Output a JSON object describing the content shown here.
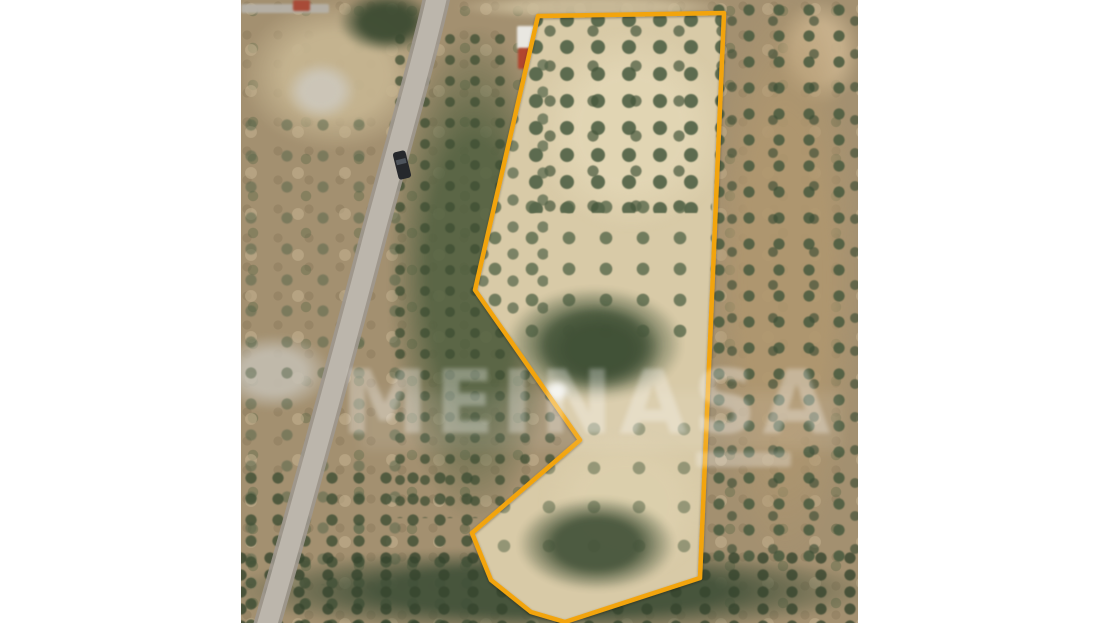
{
  "scene": {
    "description": "Aerial satellite photograph of a rural land plot with olive trees, outlined with an orange property boundary, flanked by white margins",
    "margin_color": "#ffffff"
  },
  "watermark": {
    "text": "MEINASA",
    "color": "rgba(255,255,255,0.30)"
  },
  "boundary": {
    "color": "#F2A40D",
    "stroke_width": 4.5,
    "points": [
      [
        297,
        16
      ],
      [
        483,
        13
      ],
      [
        459,
        578
      ],
      [
        324,
        622
      ],
      [
        290,
        612
      ],
      [
        250,
        580
      ],
      [
        231,
        533
      ],
      [
        339,
        440
      ],
      [
        234,
        290
      ]
    ]
  },
  "road": {
    "path": "M 197,-8 C 182,60 150,170 131,242 C 112,315 65,490 24,632",
    "casing_color": "#9e988f",
    "surface_color": "#bcb6ac"
  },
  "car": {
    "transform": "translate(161,165) rotate(-14)",
    "body_color": "#26282c",
    "glass_color": "#4e545c"
  },
  "terrain_zones": [
    {
      "layer": "photo",
      "name": "bare-ground-top-left",
      "type": "blob",
      "x": 0,
      "y": 0,
      "w": 190,
      "h": 150,
      "color": "#c6b591",
      "opacity": 0.95
    },
    {
      "layer": "photo",
      "name": "dirt-path-top",
      "type": "blob",
      "x": 215,
      "y": -6,
      "w": 275,
      "h": 26,
      "color": "#ccbd9b",
      "opacity": 0.9
    },
    {
      "layer": "photo",
      "name": "bare-ground-top-right",
      "type": "blob",
      "x": 535,
      "y": 0,
      "w": 85,
      "h": 105,
      "color": "#c9b28d",
      "opacity": 0.95
    },
    {
      "layer": "photo",
      "name": "rock-outcrop-upper",
      "type": "blob",
      "x": 45,
      "y": 62,
      "w": 70,
      "h": 58,
      "color": "#cdc8bc",
      "opacity": 0.9
    },
    {
      "layer": "photo",
      "name": "rock-outcrop-mid",
      "type": "blob",
      "x": -25,
      "y": 335,
      "w": 115,
      "h": 75,
      "color": "#c6c1b5",
      "opacity": 0.85
    },
    {
      "layer": "photo",
      "name": "scrub-left-field",
      "type": "dots",
      "x": 0,
      "y": 115,
      "w": 165,
      "h": 470,
      "color": "#55654a",
      "opacity": 0.5,
      "grid": [
        36,
        31
      ],
      "r": 8
    },
    {
      "layer": "photo",
      "name": "green-strip-base",
      "type": "blob",
      "x": 148,
      "y": 28,
      "w": 170,
      "h": 490,
      "color": "#4f5f3f",
      "opacity": 0.85
    },
    {
      "layer": "photo",
      "name": "green-strip-trees",
      "type": "dots",
      "x": 150,
      "y": 30,
      "w": 168,
      "h": 488,
      "color": "#3e4e33",
      "opacity": 0.75,
      "grid": [
        25,
        21
      ],
      "r": 7
    },
    {
      "layer": "photo",
      "name": "olive-grove-right-soil",
      "type": "blob",
      "x": 468,
      "y": -10,
      "w": 152,
      "h": 575,
      "color": "#b0976f",
      "opacity": 0.9
    },
    {
      "layer": "photo",
      "name": "olive-grove-right-trees",
      "type": "dots",
      "x": 468,
      "y": 0,
      "w": 150,
      "h": 562,
      "color": "#4d5d41",
      "opacity": 0.9,
      "grid": [
        30,
        26
      ],
      "r": 8
    },
    {
      "layer": "photo",
      "name": "olive-grove-right-trees-b",
      "type": "dots",
      "x": 468,
      "y": 0,
      "w": 150,
      "h": 562,
      "color": "#3f4f37",
      "opacity": 0.65,
      "grid": [
        41,
        33
      ],
      "r": 7,
      "offset": [
        14,
        12
      ]
    },
    {
      "layer": "photo",
      "name": "hedge-top",
      "type": "blob",
      "x": 98,
      "y": -8,
      "w": 95,
      "h": 60,
      "color": "#3c4b32",
      "opacity": 0.95
    },
    {
      "layer": "photo",
      "name": "wall-top",
      "type": "solid",
      "x": 0,
      "y": 4,
      "w": 88,
      "h": 9,
      "color": "#b6b1a7",
      "opacity": 0.95
    },
    {
      "layer": "photo",
      "name": "red-roof-hut",
      "type": "solid",
      "x": 52,
      "y": 0,
      "w": 17,
      "h": 11,
      "color": "#a84b38",
      "opacity": 1
    },
    {
      "layer": "photo",
      "name": "trees-bottom-left",
      "type": "dots",
      "x": 0,
      "y": 468,
      "w": 245,
      "h": 158,
      "color": "#3e4e34",
      "opacity": 0.8,
      "grid": [
        27,
        21
      ],
      "r": 8
    },
    {
      "layer": "photo",
      "name": "tree-band-bottom",
      "type": "blob",
      "x": -10,
      "y": 548,
      "w": 640,
      "h": 85,
      "color": "#43523a",
      "opacity": 0.95
    },
    {
      "layer": "photo",
      "name": "tree-band-bottom-texture",
      "type": "dots",
      "x": -10,
      "y": 548,
      "w": 640,
      "h": 80,
      "color": "#36452e",
      "opacity": 0.8,
      "grid": [
        29,
        17
      ],
      "r": 8
    },
    {
      "layer": "photo",
      "name": "building-white-roof",
      "type": "solid",
      "x": 276,
      "y": 26,
      "w": 21,
      "h": 23,
      "color": "#e9e7e1",
      "opacity": 1
    },
    {
      "layer": "photo",
      "name": "building-red-roof",
      "type": "solid",
      "x": 277,
      "y": 48,
      "w": 19,
      "h": 21,
      "color": "#b1452f",
      "opacity": 1
    },
    {
      "layer": "plot",
      "name": "plot-bare-soil",
      "type": "solid",
      "x": 0,
      "y": 0,
      "w": 617,
      "h": 623,
      "color": "#d8caa7",
      "opacity": 1
    },
    {
      "layer": "plot",
      "name": "plot-bright-soil-upper",
      "type": "blob",
      "x": 290,
      "y": 30,
      "w": 200,
      "h": 200,
      "color": "#e3d7b6",
      "opacity": 0.85
    },
    {
      "layer": "plot",
      "name": "plot-bright-soil-lower",
      "type": "blob",
      "x": 300,
      "y": 430,
      "w": 170,
      "h": 150,
      "color": "#ddd0ae",
      "opacity": 0.8
    },
    {
      "layer": "plot",
      "name": "plot-olive-rows-upper",
      "type": "dots",
      "x": 283,
      "y": 8,
      "w": 205,
      "h": 205,
      "color": "#56664a",
      "opacity": 0.95,
      "grid": [
        31,
        27
      ],
      "r": 10
    },
    {
      "layer": "plot",
      "name": "plot-olive-rows-upper-b",
      "type": "dots",
      "x": 283,
      "y": 8,
      "w": 205,
      "h": 205,
      "color": "#47573d",
      "opacity": 0.7,
      "grid": [
        43,
        35
      ],
      "r": 8,
      "offset": [
        16,
        13
      ]
    },
    {
      "layer": "plot",
      "name": "plot-trees-west-edge",
      "type": "dots",
      "x": 232,
      "y": 55,
      "w": 75,
      "h": 260,
      "color": "#55654a",
      "opacity": 0.7,
      "grid": [
        30,
        27
      ],
      "r": 8
    },
    {
      "layer": "plot",
      "name": "plot-olive-rows-mid",
      "type": "dots",
      "x": 243,
      "y": 196,
      "w": 228,
      "h": 150,
      "color": "#58684b",
      "opacity": 0.8,
      "grid": [
        37,
        31
      ],
      "r": 9
    },
    {
      "layer": "plot",
      "name": "plot-tree-mass-mid",
      "type": "blob",
      "x": 266,
      "y": 288,
      "w": 175,
      "h": 112,
      "color": "#4d5d41",
      "opacity": 0.95
    },
    {
      "layer": "plot",
      "name": "plot-tree-mass-mid-core",
      "type": "blob",
      "x": 298,
      "y": 308,
      "w": 120,
      "h": 82,
      "color": "#405036",
      "opacity": 0.9
    },
    {
      "layer": "plot",
      "name": "plot-trees-lower-sparse",
      "type": "dots",
      "x": 252,
      "y": 418,
      "w": 205,
      "h": 145,
      "color": "#5c6b4e",
      "opacity": 0.55,
      "grid": [
        45,
        39
      ],
      "r": 9
    },
    {
      "layer": "plot",
      "name": "plot-tree-mass-bottom",
      "type": "blob",
      "x": 278,
      "y": 498,
      "w": 155,
      "h": 92,
      "color": "#46553b",
      "opacity": 0.95
    },
    {
      "layer": "plot",
      "name": "white-rock-in-plot",
      "type": "blob",
      "x": 303,
      "y": 380,
      "w": 26,
      "h": 22,
      "color": "#f3f3ef",
      "opacity": 0.95
    }
  ]
}
